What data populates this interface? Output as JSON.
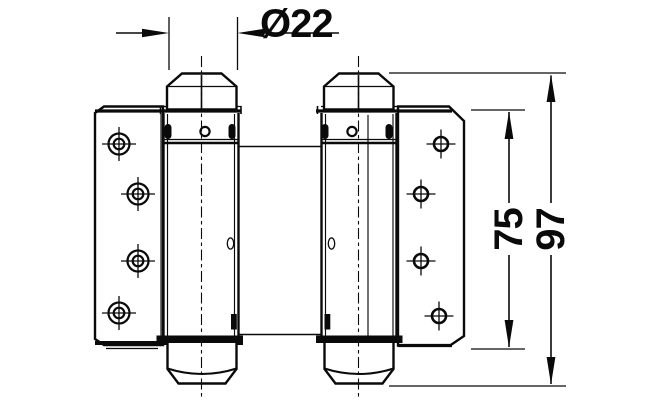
{
  "drawing": {
    "kind": "double-action spring hinge, front elevation",
    "dimensions": {
      "diameter": "Ø22",
      "plate_height": "75",
      "overall_height": "97"
    },
    "colors": {
      "line": "#0a0a0a",
      "background": "#ffffff"
    }
  }
}
